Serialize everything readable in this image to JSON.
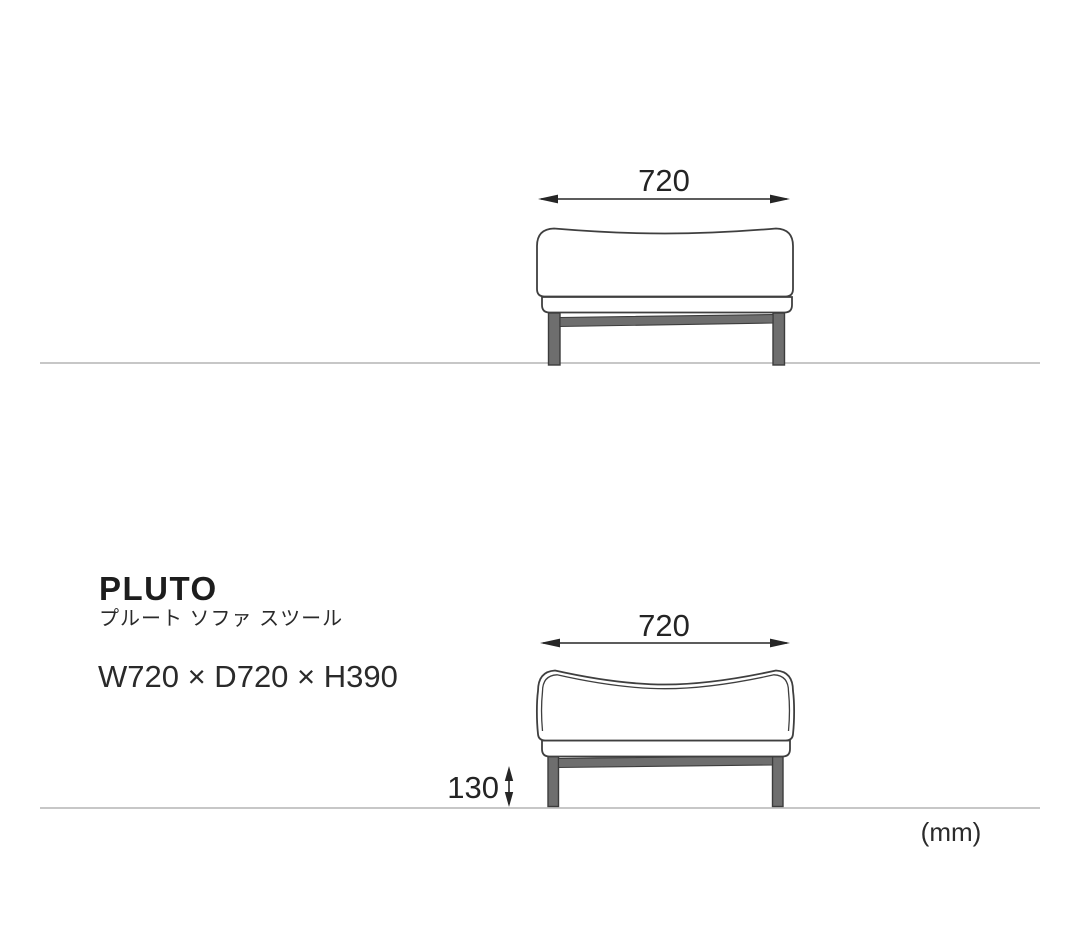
{
  "product": {
    "name": "PLUTO",
    "subtitle_ja": "プルート ソファ スツール",
    "size_text": "W720 × D720 × H390"
  },
  "views": {
    "front": {
      "width_label": "720"
    },
    "side": {
      "width_label": "720",
      "floor_clearance_label": "130"
    }
  },
  "unit_label": "(mm)",
  "dimensions_mm": {
    "width": 720,
    "depth": 720,
    "height": 390,
    "floor_clearance": 130
  },
  "colors": {
    "background": "#ffffff",
    "outline": "#3f3f3f",
    "leg_fill": "#6e6e6e",
    "dimension": "#262626",
    "ground_line": "#c7c7c7",
    "text": "#1d1d1d"
  }
}
